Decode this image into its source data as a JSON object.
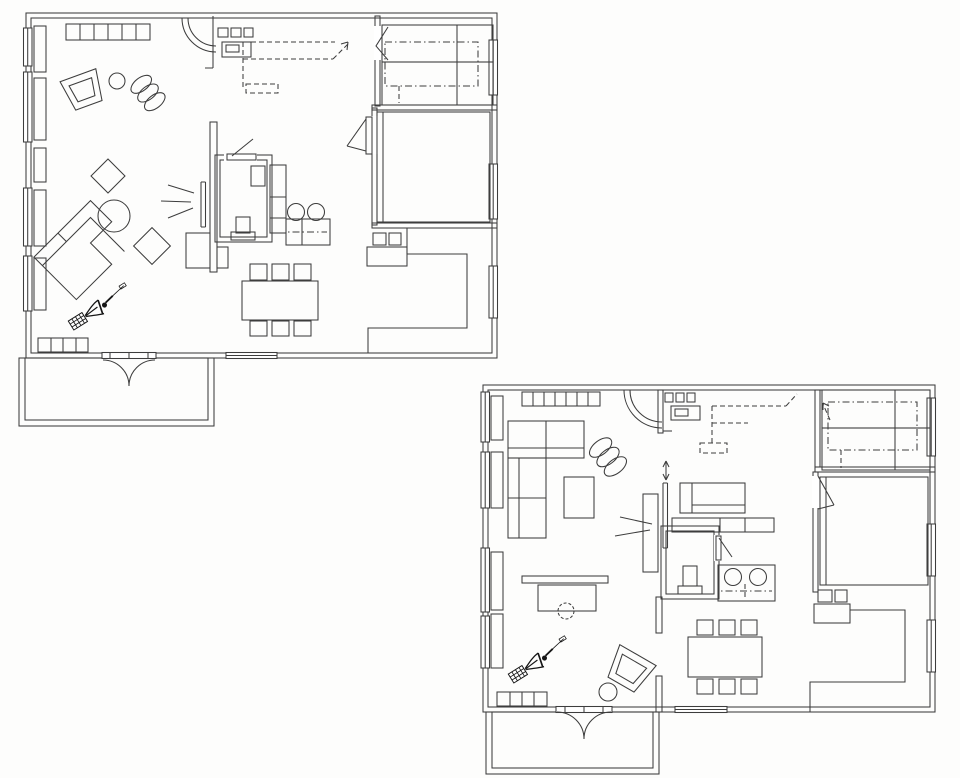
{
  "drawing": {
    "kind": "hand-drawn architectural floor plans",
    "plan_count": 2,
    "text_labels": []
  },
  "colors": {
    "background": "#fdfdfc",
    "line": "#3d3d3d",
    "figure": "#161616"
  },
  "plans": [
    {
      "id": "plan-a",
      "position": "upper-left",
      "rooms": [
        "living-area",
        "kitchen",
        "wc-bathroom",
        "bedroom",
        "study-room",
        "dining-area",
        "balcony"
      ],
      "furniture_icons": [
        "wall-shelf-row",
        "armchair",
        "side-table",
        "lounge-ellipses",
        "corner-sofa",
        "round-coffee-table",
        "diamond-cushions",
        "screen-panel",
        "light-rays",
        "dining-table",
        "dining-chairs",
        "kitchen-stove",
        "kitchen-sink",
        "overhead-cabinets-dashed",
        "counter-twin-sinks",
        "tall-cabinet",
        "toilet",
        "wash-basin",
        "double-bed",
        "dresser",
        "sideboard",
        "entrance-double-door",
        "door-swing-arc",
        "person-vacuuming-icon",
        "window-sills"
      ]
    },
    {
      "id": "plan-b",
      "position": "lower-right",
      "rooms": [
        "living-area",
        "kitchen",
        "wc",
        "bedroom",
        "study-room",
        "dining-area",
        "balcony"
      ],
      "furniture_icons": [
        "wall-shelf-row",
        "corner-sofa",
        "coffee-table",
        "lounge-ellipses",
        "writing-desk",
        "desk-chair",
        "armchair",
        "stool",
        "screen-panel",
        "up-down-arrow",
        "light-rays",
        "bench-seat",
        "counter-bar",
        "counter-twin-sinks",
        "toilet",
        "double-bed",
        "dresser",
        "sideboard",
        "dining-table",
        "dining-chairs",
        "kitchen-stove",
        "kitchen-sink",
        "overhead-cabinets-dashed",
        "entrance-double-door",
        "door-swing-arc",
        "person-vacuuming-icon",
        "window-sills"
      ]
    }
  ]
}
